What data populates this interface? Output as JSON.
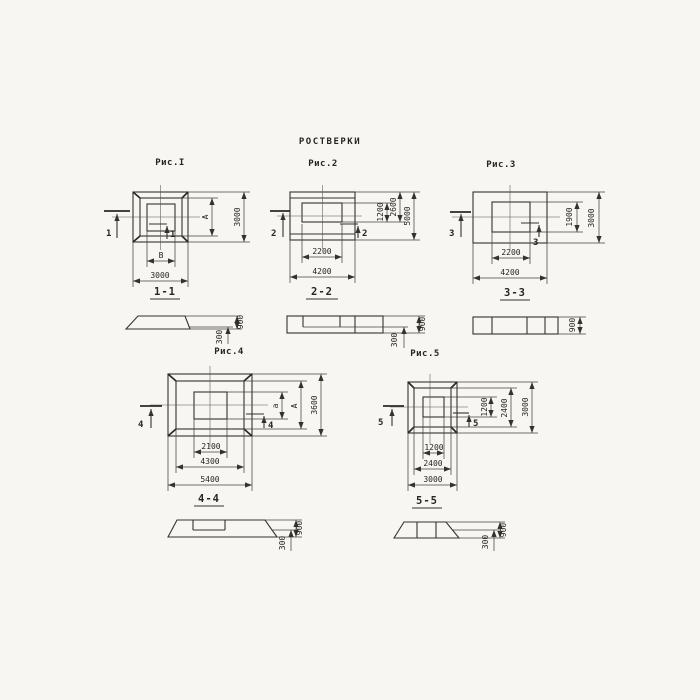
{
  "title": "РОСТВЕРКИ",
  "fig1": {
    "title": "Рис.I",
    "cut": "1",
    "dim_inner_w": "В",
    "dim_outer_w": "3000",
    "dim_inner_h": "А",
    "dim_outer_h": "3000",
    "section": {
      "label": "1-1",
      "h_total": "900",
      "h_step": "300"
    }
  },
  "fig2": {
    "title": "Рис.2",
    "cut": "2",
    "dim_inner_w": "2200",
    "dim_outer_w": "4200",
    "dim_inner_h": "1200",
    "dim_mid_h": "2600",
    "dim_outer_h": "5000",
    "section": {
      "label": "2-2",
      "h_total": "900",
      "h_step": "300"
    }
  },
  "fig3": {
    "title": "Рис.3",
    "cut": "3",
    "dim_inner_w": "2200",
    "dim_outer_w": "4200",
    "dim_inner_h": "1900",
    "dim_outer_h": "3000",
    "section": {
      "label": "3-3",
      "h_total": "900"
    }
  },
  "fig4": {
    "title": "Рис.4",
    "cut": "4",
    "dim_inner_w": "2100",
    "dim_mid_w": "4300",
    "dim_outer_w": "5400",
    "dim_inner_h": "а",
    "dim_mid_h": "А",
    "dim_outer_h": "3600",
    "section": {
      "label": "4-4",
      "h_total": "900",
      "h_step": "300"
    }
  },
  "fig5": {
    "title": "Рис.5",
    "cut": "5",
    "dim_inner_w": "1200",
    "dim_mid_w": "2400",
    "dim_outer_w": "3000",
    "dim_inner_h": "1200",
    "dim_mid_h": "2400",
    "dim_outer_h": "3000",
    "section": {
      "label": "5-5",
      "h_total": "900",
      "h_step": "300"
    }
  }
}
